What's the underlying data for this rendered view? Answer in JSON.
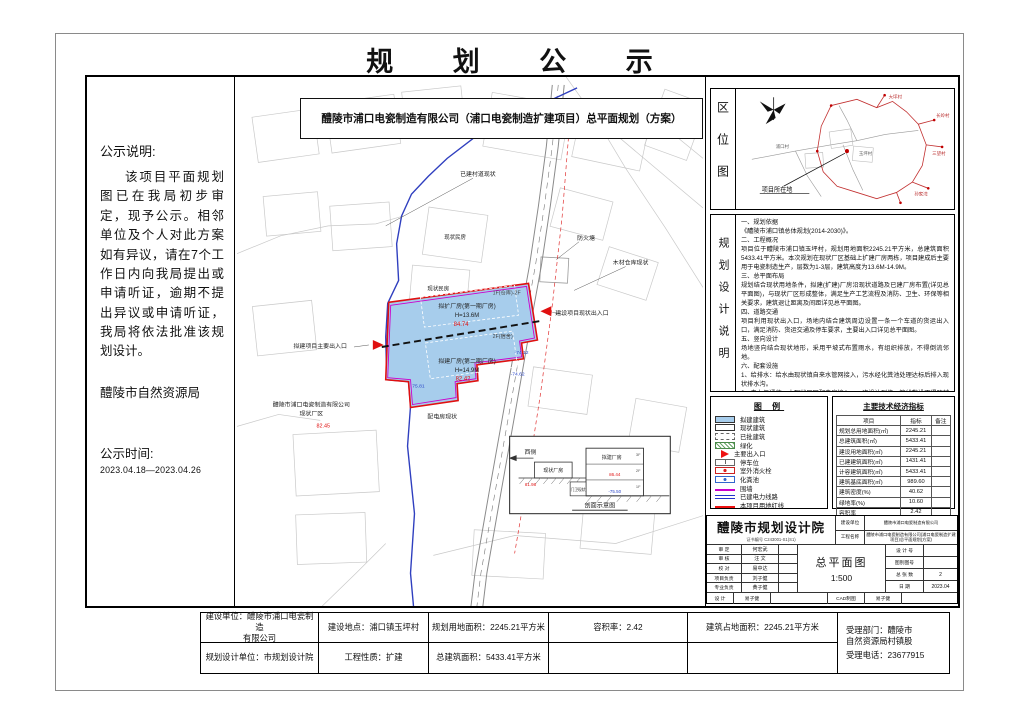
{
  "sheet": {
    "title": "规 划 公 示"
  },
  "notice": {
    "heading": "公示说明:",
    "body": "该项目平面规划图已在我局初步审定，现予公示。相邻单位及个人对此方案如有异议，请在7个工作日内向我局提出或申请听证，逾期不提出异议或申请听证，我局将依法批准该规划设计。",
    "authority": "醴陵市自然资源局",
    "time_label": "公示时间:",
    "time_range": "2023.04.18—2023.04.26"
  },
  "drawing": {
    "title": "醴陵市浦口电瓷制造有限公司（浦口电瓷制造扩建项目）总平面规划（方案）",
    "labels": {
      "road_status": "已建村道现状",
      "house_1": "现状民房",
      "house_2": "现状民房",
      "fire_pond": "防火塘",
      "timber_warehouse": "木材仓库现状",
      "existing_entrance": "建设项目现状出入口",
      "main_entrance": "拟建项目主要出入口",
      "existing_factory_line1": "醴陵市浦口电瓷制造有限公司",
      "existing_factory_line2": "现状厂区",
      "existing_factory_elev": "82.45",
      "power_room": "配电房现状",
      "workshop1_name": "拟扩厂房(第一期厂房)",
      "workshop1_height": "H=13.6M",
      "workshop1_elev": "84.74",
      "workshop1_floors": "1F(仓库)-2F",
      "workshop2_name": "拟建厂房(第二期厂房)",
      "workshop2_height": "H=14.9M",
      "workshop2_elev": "82.42",
      "workshop2_floors": "2F(宿舍)",
      "spot_elev_1": "-74.12",
      "spot_elev_2": "-74.62",
      "spot_elev_3": "75.81"
    },
    "section": {
      "west": "西侧",
      "existing_building": "现状厂房",
      "proposed_building": "拟建厂房",
      "guard": "门卫现状",
      "floor3": "3F",
      "floor2": "2F",
      "floor1": "1F",
      "elev_existing": "81.98",
      "elev_top": "86.44",
      "elev_bottom": "-75.50",
      "caption": "剖面示意图"
    }
  },
  "location_map": {
    "panel_title": "区位图",
    "pointer_label": "项目所在地",
    "places": [
      "浦口村",
      "玉坪村",
      "大坪村",
      "长岭村",
      "三望村",
      "孙家湾"
    ]
  },
  "design_notes": {
    "panel_title": "规划设计说明",
    "text": "一、规划依据\n《醴陵市浦口镇总体规划(2014-2030)》。\n二、工程概况\n项目位于醴陵市浦口镇玉坪村，规划用地面积2245.21平方米，总建筑面积5433.41平方米。本次规划在现状厂区基础上扩建厂房两栋，项目建成后主要用于电瓷制造生产，层数为1-3层，建筑高度为13.6M-14.9M。\n三、总平面布局\n规划结合现状用地条件，拟建(扩建)厂房沿现状道路及已建厂房布置(详见总平面图)，与现状厂区形成整体，满足生产工艺流程及消防、卫生、环保等相关要求，建筑退让距离及间距详见总平面图。\n四、道路交通\n项目利用现状出入口，场地内结合建筑周边设置一条一个车道的货运出入口，满足消防、货运交通及停车要求，主要出入口详见总平面图。\n五、竖向设计\n场地竖向结合现状地形，采用平坡式布置雨水，有组织排放，不得倒流邻地。\n六、配套设施\n1、给排水：给水由现状镇自来水管网接入，污水经化粪池处理达标后排入现状排水沟。\n2、电力与通信：由现状厂区配电房接入，一次设计到位，管线敷设不得跨越红线、围墙、出口。\n3、图中所标尺寸均以米为单位标注(详见图纸)，标高采用相对标高，建筑间距及退让详见总平面图。"
  },
  "legend": {
    "title": "图 例",
    "items": [
      {
        "label": "拟建建筑"
      },
      {
        "label": "现状建筑"
      },
      {
        "label": "已批建筑"
      },
      {
        "label": "绿化"
      },
      {
        "label": "主要出入口"
      },
      {
        "label": "停车位"
      },
      {
        "label": "室外消火栓"
      },
      {
        "label": "化粪池"
      },
      {
        "label": "围墙"
      },
      {
        "label": "已建电力线路"
      },
      {
        "label": "本项目用地红线"
      }
    ]
  },
  "indicators": {
    "title": "主要技术经济指标",
    "columns": [
      "项目",
      "指标",
      "备注"
    ],
    "rows": [
      {
        "name": "规划总用地面积(㎡)",
        "value": "2245.21",
        "note": ""
      },
      {
        "name": "总建筑面积(㎡)",
        "value": "5433.41",
        "note": ""
      },
      {
        "name": "建设用地面积(㎡)",
        "value": "2245.21",
        "note": ""
      },
      {
        "name": "已建建筑面积(㎡)",
        "value": "1431.41",
        "note": ""
      },
      {
        "name": "计容建筑面积(㎡)",
        "value": "5433.41",
        "note": ""
      },
      {
        "name": "建筑基底面积(㎡)",
        "value": "989.60",
        "note": ""
      },
      {
        "name": "建筑密度(%)",
        "value": "40.62",
        "note": ""
      },
      {
        "name": "绿地率(%)",
        "value": "10.60",
        "note": ""
      },
      {
        "name": "容积率",
        "value": "2.42",
        "note": ""
      }
    ]
  },
  "title_block": {
    "institute": "醴陵市规划设计院",
    "certificate": "证书编号 C243001-S1(S1)",
    "build_unit_label": "建设单位",
    "build_unit": "醴陵市浦口电瓷制造有限公司",
    "project_label": "工程名称",
    "project": "醴陵市浦口电瓷制造有限公司(浦口电瓷制造扩建项目)总平面规划(方案)",
    "rows_left": [
      {
        "label": "审 定",
        "value": "何宏武"
      },
      {
        "label": "审 核",
        "value": "汪 文"
      },
      {
        "label": "校 对",
        "value": "易中达"
      },
      {
        "label": "项目负责",
        "value": "刘子健"
      },
      {
        "label": "专业负责",
        "value": "黄子健"
      }
    ],
    "drawing_name": "总平面图",
    "scale": "1:500",
    "rows_right": [
      {
        "label": "设 计 号",
        "value": ""
      },
      {
        "label": "图别图号",
        "value": ""
      },
      {
        "label": "总 张 数",
        "value": "2"
      },
      {
        "label": "日 期",
        "value": "2023.04"
      }
    ],
    "designer_label": "设 计",
    "designer": "易子健",
    "cad_label": "CAD制图",
    "cad": "易子健"
  },
  "footer": {
    "build_unit": "建设单位：醴陵市浦口电瓷制造\n有限公司",
    "design_unit": "规划设计单位：市规划设计院",
    "location": "建设地点：浦口镇玉坪村",
    "nature": "工程性质：扩建",
    "land_area": "规划用地面积：2245.21平方米",
    "total_area": "总建筑面积：5433.41平方米",
    "far": "容积率：2.42",
    "footprint": "建筑占地面积：2245.21平方米",
    "dept": "受理部门：醴陵市\n自然资源局村镇股",
    "phone": "受理电话：23677915"
  }
}
